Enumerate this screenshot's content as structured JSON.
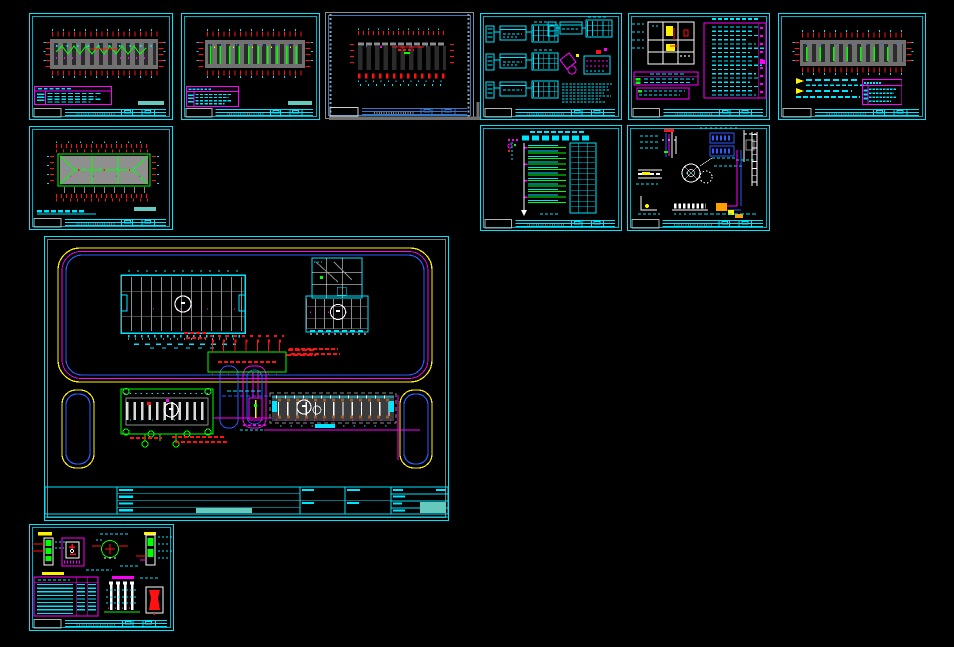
{
  "window": {
    "app": "cad-model-space",
    "width": 954,
    "height": 647,
    "background": "#000000",
    "legible_text": []
  },
  "palette": {
    "cyan": "#00E5FF",
    "cyan_dim": "#00AFC4",
    "teal_fill": "#66C9BE",
    "magenta": "#FF00FF",
    "red": "#FF1111",
    "green": "#00FF00",
    "yellow": "#FFF200",
    "blue": "#2E5BFF",
    "steel_blue": "#3578C8",
    "white": "#FFFFFF",
    "gray": "#8C8C8C",
    "dark_gray": "#6F6F6F",
    "slab_gray": "#707070",
    "roof_gray": "#8F8F8F",
    "brown": "#9A5B2E",
    "orange": "#FFA000",
    "selection_gray": "#A0A0A0"
  },
  "sheets": [
    {
      "id": "floor-plan-sheet-1",
      "x": 29,
      "y": 13,
      "w": 144,
      "h": 107,
      "selected": false,
      "frame": {
        "outer": "#00E5FF",
        "inner": "#00AFC4"
      },
      "strip": {
        "show": true,
        "cls": "strip"
      }
    },
    {
      "id": "floor-plan-sheet-2",
      "x": 181,
      "y": 13,
      "w": 139,
      "h": 107,
      "selected": false,
      "frame": {
        "outer": "#00E5FF",
        "inner": "#00AFC4"
      },
      "strip": {
        "show": true,
        "cls": "strip"
      }
    },
    {
      "id": "viewport-sheet-selected",
      "x": 325,
      "y": 12,
      "w": 149,
      "h": 107,
      "selected": true,
      "frame": {
        "outer": "#8C8C8C",
        "inner": "#3578C8"
      },
      "strip": {
        "show": true,
        "cls": "strip-blue"
      }
    },
    {
      "id": "distribution-schematic-sheet",
      "x": 480,
      "y": 13,
      "w": 142,
      "h": 107,
      "selected": false,
      "frame": {
        "outer": "#00E5FF",
        "inner": "#00AFC4"
      },
      "strip": {
        "show": true,
        "cls": "strip"
      }
    },
    {
      "id": "legend-notes-sheet",
      "x": 628,
      "y": 13,
      "w": 142,
      "h": 107,
      "selected": false,
      "frame": {
        "outer": "#00E5FF",
        "inner": "#00AFC4"
      },
      "strip": {
        "show": true,
        "cls": "strip"
      }
    },
    {
      "id": "floor-plan-sheet-3",
      "x": 778,
      "y": 13,
      "w": 148,
      "h": 107,
      "selected": false,
      "frame": {
        "outer": "#00E5FF",
        "inner": "#00AFC4"
      },
      "strip": {
        "show": true,
        "cls": "strip"
      }
    },
    {
      "id": "roof-plan-sheet",
      "x": 29,
      "y": 126,
      "w": 144,
      "h": 104,
      "selected": false,
      "frame": {
        "outer": "#00E5FF",
        "inner": "#00AFC4"
      },
      "strip": {
        "show": true,
        "cls": "strip"
      }
    },
    {
      "id": "riser-diagram-sheet",
      "x": 480,
      "y": 125,
      "w": 142,
      "h": 106,
      "selected": false,
      "frame": {
        "outer": "#00E5FF",
        "inner": "#00AFC4"
      },
      "strip": {
        "show": true,
        "cls": "strip"
      }
    },
    {
      "id": "installation-details-sheet",
      "x": 627,
      "y": 125,
      "w": 143,
      "h": 106,
      "selected": false,
      "frame": {
        "outer": "#00E5FF",
        "inner": "#00AFC4"
      },
      "strip": {
        "show": true,
        "cls": "strip"
      }
    },
    {
      "id": "site-plan-sheet",
      "x": 44,
      "y": 236,
      "w": 405,
      "h": 285,
      "selected": false,
      "frame": {
        "outer": "#00E5FF",
        "inner": "#7A7A7A"
      },
      "strip": {
        "show": false,
        "cls": ""
      }
    },
    {
      "id": "grounding-details-sheet",
      "x": 29,
      "y": 524,
      "w": 145,
      "h": 107,
      "selected": false,
      "frame": {
        "outer": "#00E5FF",
        "inner": "#00AFC4"
      },
      "strip": {
        "show": true,
        "cls": "strip"
      }
    }
  ]
}
